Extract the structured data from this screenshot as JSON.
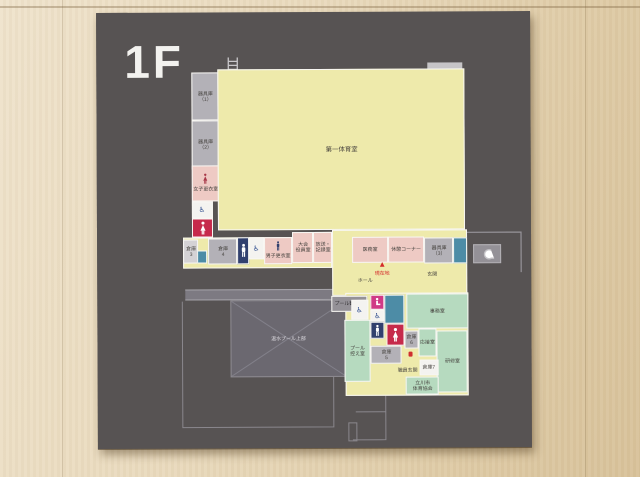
{
  "sign": {
    "floor_label": "1F",
    "you_are_here": "現在地",
    "pool_upper": "温水プール上部"
  },
  "rooms": {
    "gym": "第一体育室",
    "equipment1": [
      "器具庫",
      "（1）"
    ],
    "equipment2": [
      "器具庫",
      "（2）"
    ],
    "equipment3": [
      "器具庫",
      "（3）"
    ],
    "womens_locker": "女子更衣室",
    "mens_locker": "男子更衣室",
    "storage3": [
      "倉庫",
      "3"
    ],
    "storage4": [
      "倉庫",
      "4"
    ],
    "storage5": [
      "倉庫",
      "5"
    ],
    "storage6": [
      "倉庫",
      "6"
    ],
    "storage7": "倉庫7",
    "officials": [
      "大会",
      "役員室"
    ],
    "broadcast": [
      "放送・",
      "記録室"
    ],
    "medical": "医務室",
    "rest_corner": "休憩コーナー",
    "hall": "ホール",
    "entrance": "玄関",
    "staff_entrance": "職員玄関",
    "pool_viewing": "プール観覧室",
    "pool_anteroom": [
      "プール",
      "控え室"
    ],
    "office": "事務室",
    "reception": "応接室",
    "training": "研修室",
    "sports_assoc": [
      "立川市",
      "体育協会"
    ]
  },
  "icons": {
    "wheelchair": "♿",
    "you_are_here_marker": "▲"
  },
  "colors": {
    "panel": "#575353",
    "room_yellow": "#eeeaab",
    "room_pink": "#eecac4",
    "room_green": "#b6dabf",
    "room_gray": "#b3b1b7",
    "toilet_navy": "#31406e",
    "toilet_crimson": "#c62a4b",
    "nursing_magenta": "#d03a86",
    "stairs_teal": "#4d8ca6",
    "marker_red": "#d42a2a"
  }
}
